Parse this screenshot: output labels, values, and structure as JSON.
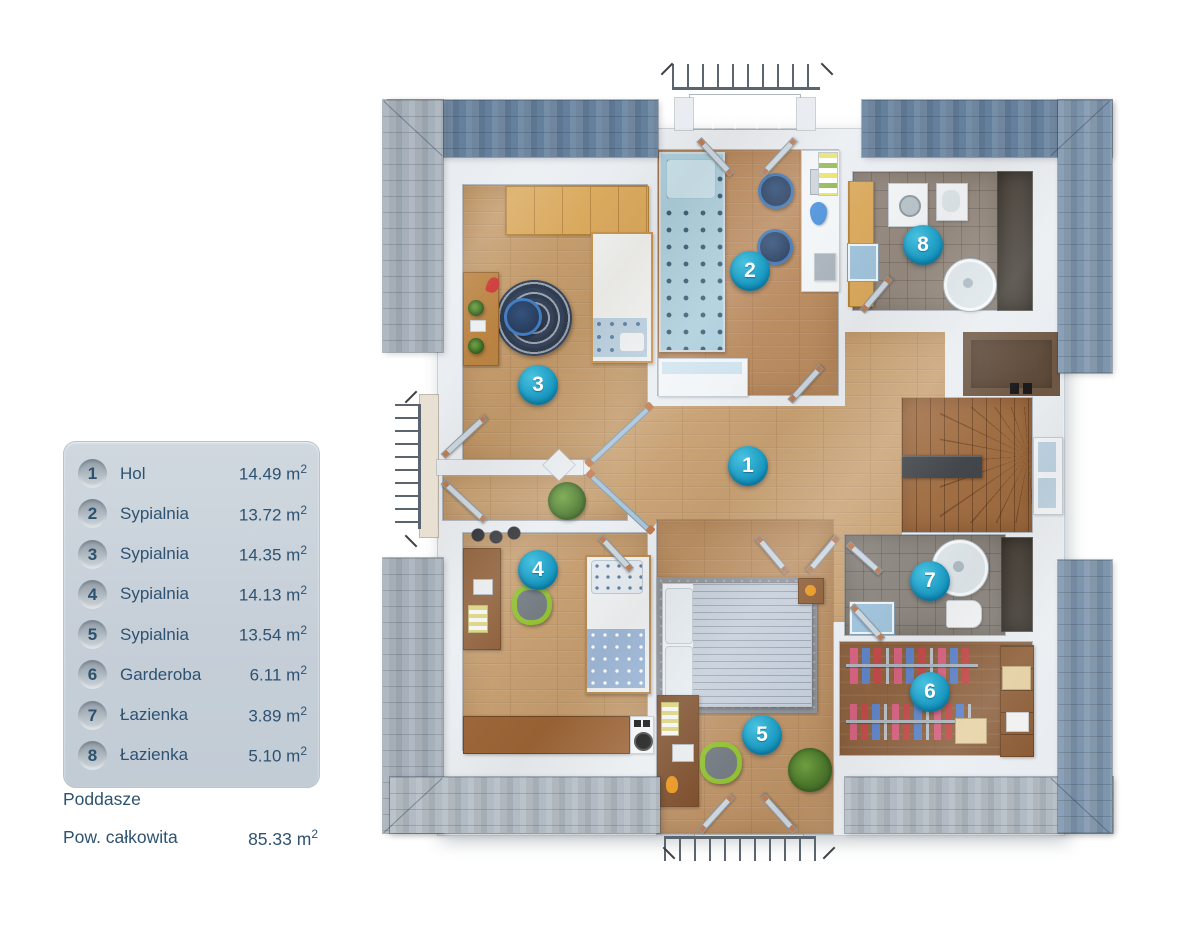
{
  "legend": {
    "items": [
      {
        "number": "1",
        "label": "Hol",
        "area": "14.49"
      },
      {
        "number": "2",
        "label": "Sypialnia",
        "area": "13.72"
      },
      {
        "number": "3",
        "label": "Sypialnia",
        "area": "14.35"
      },
      {
        "number": "4",
        "label": "Sypialnia",
        "area": "14.13"
      },
      {
        "number": "5",
        "label": "Sypialnia",
        "area": "13.54"
      },
      {
        "number": "6",
        "label": "Garderoba",
        "area": "6.11"
      },
      {
        "number": "7",
        "label": "Łazienka",
        "area": "3.89"
      },
      {
        "number": "8",
        "label": "Łazienka",
        "area": "5.10"
      }
    ]
  },
  "units": {
    "base": "m",
    "exp": "2"
  },
  "footer": {
    "floor_label": "Poddasze",
    "total_label": "Pow. całkowita",
    "total_area": "85.33"
  },
  "plan": {
    "badges": [
      "1",
      "2",
      "3",
      "4",
      "5",
      "6",
      "7",
      "8"
    ]
  },
  "colors": {
    "text_navy": "#2d5272",
    "badge_teal": "#1190ba",
    "roof_dark_blue": "#64809d",
    "roof_light_gray": "#a6b0ba",
    "wall_white": "#e9edf1",
    "wood_hall": "#c8a173",
    "wood_dark": "#8d6240",
    "tile_gray": "#8c8680"
  }
}
